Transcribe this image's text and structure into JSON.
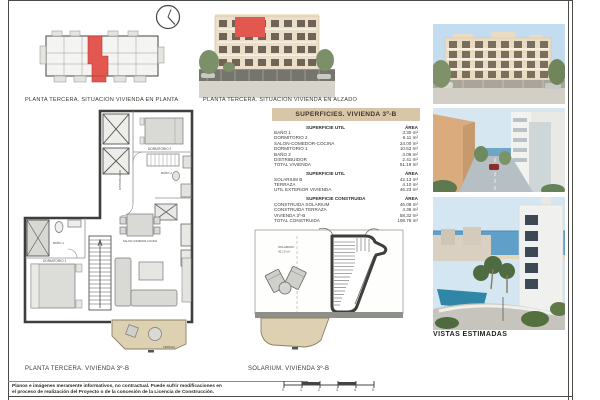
{
  "sheet": {
    "captions": {
      "situacion_planta": "PLANTA TERCERA. SITUACION VIVIENDA EN PLANTA",
      "situacion_alzado": "PLANTA TERCERA. SITUACION VIVIENDA EN ALZADO",
      "planta_vivienda": "PLANTA TERCERA. VIVIENDA 3º-B",
      "solarium": "SOLARIUM. VIVIENDA 3º-B",
      "vistas": "VISTAS ESTIMADAS"
    },
    "disclaimer": {
      "line1": "Planos e imágenes meramente informativos, no contractual. Puede sufrir modificaciones en",
      "line2": "el proceso de realización del Proyecto o de la concesión de la Licencia de Construcción."
    }
  },
  "areas_table": {
    "title": "SUPERFICIES. VIVIENDA 3º-B",
    "sections": [
      {
        "header": "SUPERFICIE UTIL",
        "area_header": "ÁREA",
        "rows": [
          {
            "label": "BAÑO 1",
            "value": "3.30 m²"
          },
          {
            "label": "DORMITORIO 2",
            "value": "6.11 m²"
          },
          {
            "label": "SALON-COMEDOR-COCINA",
            "value": "24.00 m²"
          },
          {
            "label": "DORMITORIO 1",
            "value": "10.53 m²"
          },
          {
            "label": "BAÑO 2",
            "value": "3.06 m²"
          },
          {
            "label": "DISTRIBUIDOR",
            "value": "2.41 m²"
          },
          {
            "label": "TOTAL VIVIENDA",
            "value": "51.19 m²"
          }
        ]
      },
      {
        "header": "SUPERFICIE UTIL",
        "area_header": "ÁREA",
        "rows": [
          {
            "label": "SOLARIUM B",
            "value": "42.13 m²"
          },
          {
            "label": "TERRAZA",
            "value": "4.10 m²"
          },
          {
            "label": "UTIL EXTERIOR VIVIENDA",
            "value": "46.23 m²"
          }
        ]
      },
      {
        "header": "SUPERFICIE CONSTRUIDA",
        "area_header": "ÁREA",
        "rows": [
          {
            "label": "CONSTRUIDA SOLARIUM",
            "value": "46.08 m²"
          },
          {
            "label": "CONSTRUIDA TERRAZA",
            "value": "4.36 m²"
          },
          {
            "label": "VIVIENDA 3º-B",
            "value": "58.32 m²"
          },
          {
            "label": "TOTAL CONSTRUIDA",
            "value": "108.76 m²"
          }
        ]
      }
    ]
  },
  "floor_plan": {
    "rooms": {
      "dormitorio2": "DORMITORIO 2",
      "bano2": "BAÑO 2",
      "distribuidor": "DISTRIBUIDOR",
      "bano1": "BAÑO 1",
      "dormitorio1": "DORMITORIO 1",
      "salon": "SALON-COMEDOR-COCINA",
      "terraza": "TERRAZA"
    }
  },
  "solarium_plan": {
    "label": "SOLARIUM",
    "area": "42.13 m²"
  },
  "scale_bar": {
    "ticks": [
      "0",
      "1",
      "2",
      "3",
      "4",
      "5"
    ]
  },
  "colors": {
    "highlight_red": "#e25750",
    "table_header_tan": "#d9c6a9",
    "terrace_beige": "#ded1b2",
    "wall_dark": "#3e3e3a"
  }
}
